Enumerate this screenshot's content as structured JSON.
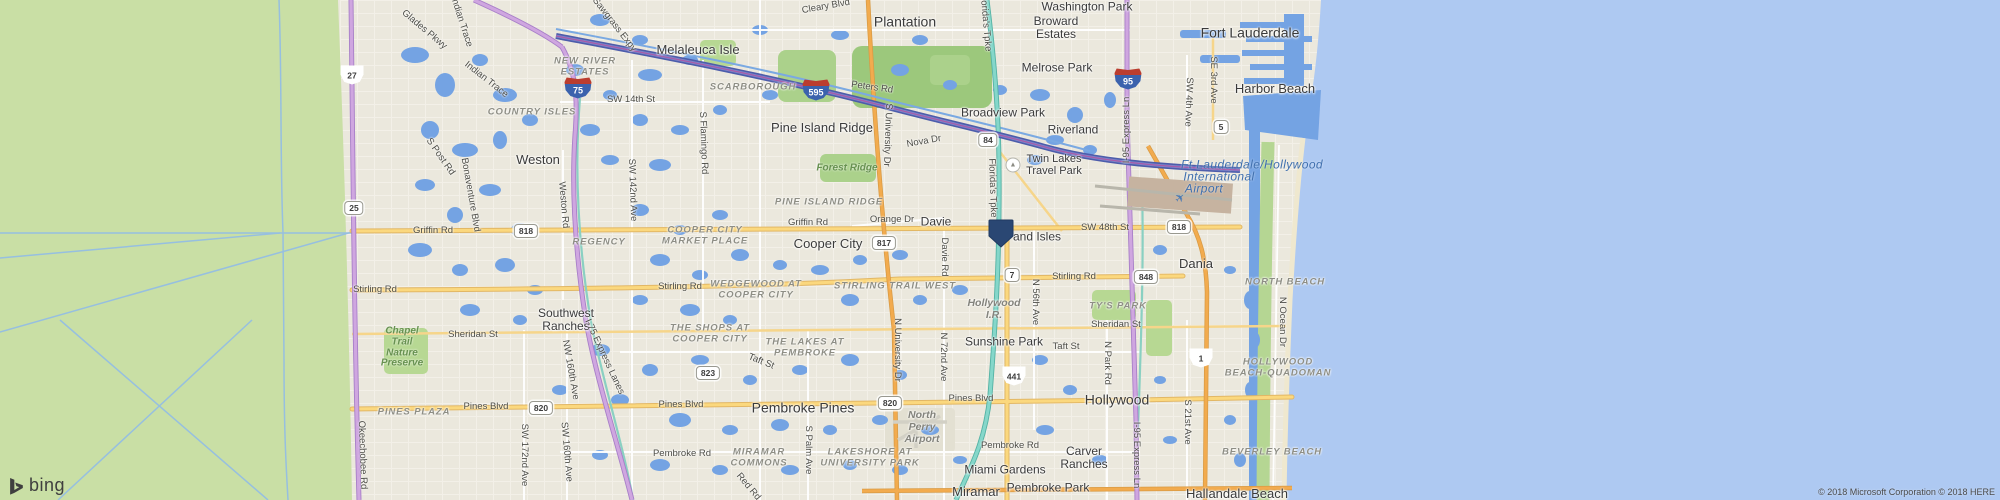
{
  "map": {
    "logo_text": "bing",
    "copyright": "© 2018 Microsoft Corporation © 2018 HERE",
    "colors": {
      "ocean": "#aec9f2",
      "land": "#ebe8dd",
      "everglades": "#c9dfa5",
      "inland_water": "#74a3e3",
      "road_yellow": "#fbd87e",
      "road_orange": "#f2ab4e",
      "toll_purple": "#cfa6e0",
      "turnpike_teal": "#85d7ca",
      "i595_blue": "#4d5cab",
      "marker": "#2a4773",
      "interstate_shield_blue": "#3b62ad",
      "interstate_shield_red": "#bb3d2f"
    },
    "marker": {
      "x": 1001,
      "y": 236,
      "color": "#2a4773"
    },
    "labels": {
      "cities": [
        {
          "t": "Plantation",
          "x": 905,
          "y": 22,
          "s": 14
        },
        {
          "t": "Fort Lauderdale",
          "x": 1250,
          "y": 33,
          "s": 14
        },
        {
          "t": "Washington Park",
          "x": 1087,
          "y": 7,
          "s": 12
        },
        {
          "t": "Broward\nEstates",
          "x": 1056,
          "y": 28,
          "s": 12
        },
        {
          "t": "Melaleuca Isle",
          "x": 698,
          "y": 50,
          "s": 13
        },
        {
          "t": "Melrose Park",
          "x": 1057,
          "y": 68,
          "s": 12
        },
        {
          "t": "Harbor Beach",
          "x": 1275,
          "y": 89,
          "s": 13
        },
        {
          "t": "Pine Island Ridge",
          "x": 822,
          "y": 128,
          "s": 13
        },
        {
          "t": "Broadview Park",
          "x": 1003,
          "y": 113,
          "s": 12
        },
        {
          "t": "Riverland",
          "x": 1073,
          "y": 130,
          "s": 12
        },
        {
          "t": "Weston",
          "x": 538,
          "y": 160,
          "s": 13
        },
        {
          "t": "Davie",
          "x": 936,
          "y": 222,
          "s": 12
        },
        {
          "t": "Cooper City",
          "x": 828,
          "y": 244,
          "s": 13
        },
        {
          "t": "Dania",
          "x": 1196,
          "y": 264,
          "s": 13
        },
        {
          "t": "Southwest\nRanches",
          "x": 566,
          "y": 320,
          "s": 12
        },
        {
          "t": "Sunshine Park",
          "x": 1004,
          "y": 342,
          "s": 12
        },
        {
          "t": "Pembroke Pines",
          "x": 803,
          "y": 408,
          "s": 14
        },
        {
          "t": "Hollywood",
          "x": 1117,
          "y": 400,
          "s": 14
        },
        {
          "t": "Carver\nRanches",
          "x": 1084,
          "y": 458,
          "s": 12
        },
        {
          "t": "Miami Gardens",
          "x": 1005,
          "y": 470,
          "s": 12
        },
        {
          "t": "Miramar",
          "x": 976,
          "y": 492,
          "s": 13
        },
        {
          "t": "Pembroke Park",
          "x": 1048,
          "y": 488,
          "s": 12
        },
        {
          "t": "Hallandale Beach",
          "x": 1237,
          "y": 494,
          "s": 13
        },
        {
          "t": "and Isles",
          "x": 1037,
          "y": 237,
          "s": 12
        },
        {
          "t": "Twin Lakes\nTravel Park",
          "x": 1054,
          "y": 166,
          "s": 11
        }
      ],
      "neighborhoods": [
        {
          "t": "NEW RIVER\nESTATES",
          "x": 585,
          "y": 67
        },
        {
          "t": "COUNTRY ISLES",
          "x": 532,
          "y": 112
        },
        {
          "t": "SCARBOROUGH",
          "x": 753,
          "y": 87
        },
        {
          "t": "REGENCY",
          "x": 599,
          "y": 242
        },
        {
          "t": "COOPER CITY\nMARKET PLACE",
          "x": 705,
          "y": 236
        },
        {
          "t": "PINE ISLAND RIDGE",
          "x": 829,
          "y": 202
        },
        {
          "t": "WEDGEWOOD AT\nCOOPER CITY",
          "x": 756,
          "y": 290
        },
        {
          "t": "STIRLING TRAIL WEST",
          "x": 895,
          "y": 286
        },
        {
          "t": "THE SHOPS AT\nCOOPER CITY",
          "x": 710,
          "y": 334
        },
        {
          "t": "THE LAKES AT\nPEMBROKE",
          "x": 805,
          "y": 348
        },
        {
          "t": "PINES PLAZA",
          "x": 414,
          "y": 412
        },
        {
          "t": "MIRAMAR\nCOMMONS",
          "x": 759,
          "y": 458
        },
        {
          "t": "LAKESHORE AT\nUNIVERSITY PARK",
          "x": 870,
          "y": 458
        },
        {
          "t": "TY'S PARK",
          "x": 1118,
          "y": 306
        },
        {
          "t": "NORTH BEACH",
          "x": 1285,
          "y": 282
        },
        {
          "t": "HOLLYWOOD\nBEACH-QUADOMAN",
          "x": 1278,
          "y": 368
        },
        {
          "t": "BEVERLEY BEACH",
          "x": 1272,
          "y": 452
        }
      ],
      "nature_green": [
        {
          "t": "Forest Ridge",
          "x": 847,
          "y": 169
        },
        {
          "t": "Chapel\nTrail\nNature\nPreserve",
          "x": 402,
          "y": 348
        }
      ],
      "nature_gray": [
        {
          "t": "Hollywood\nI.R.",
          "x": 994,
          "y": 309
        },
        {
          "t": "North\nPerry\nAirport",
          "x": 922,
          "y": 427
        }
      ],
      "water": [
        {
          "t": "Ft Lauderdale/Hollywood",
          "x": 1252,
          "y": 165
        },
        {
          "t": "International",
          "x": 1219,
          "y": 177
        },
        {
          "t": "Airport",
          "x": 1204,
          "y": 189
        }
      ],
      "roads": [
        {
          "t": "Griffin Rd",
          "x": 433,
          "y": 231,
          "r": 0
        },
        {
          "t": "Griffin Rd",
          "x": 808,
          "y": 223,
          "r": 0
        },
        {
          "t": "Orange Dr",
          "x": 892,
          "y": 220,
          "r": 0
        },
        {
          "t": "Stirling Rd",
          "x": 375,
          "y": 290,
          "r": 0
        },
        {
          "t": "Stirling Rd",
          "x": 680,
          "y": 287,
          "r": 0
        },
        {
          "t": "Stirling Rd",
          "x": 1074,
          "y": 277,
          "r": 0
        },
        {
          "t": "Sheridan St",
          "x": 473,
          "y": 335,
          "r": 0
        },
        {
          "t": "Sheridan St",
          "x": 1116,
          "y": 325,
          "r": 0
        },
        {
          "t": "Pines Blvd",
          "x": 486,
          "y": 407,
          "r": 0
        },
        {
          "t": "Pines Blvd",
          "x": 681,
          "y": 405,
          "r": 0
        },
        {
          "t": "Pines Blvd",
          "x": 971,
          "y": 399,
          "r": 0
        },
        {
          "t": "Pembroke Rd",
          "x": 682,
          "y": 454,
          "r": 0
        },
        {
          "t": "Pembroke Rd",
          "x": 1010,
          "y": 446,
          "r": 0
        },
        {
          "t": "Taft St",
          "x": 761,
          "y": 362,
          "r": 22
        },
        {
          "t": "Taft St",
          "x": 1066,
          "y": 347,
          "r": 0
        },
        {
          "t": "SW 14th St",
          "x": 631,
          "y": 100,
          "r": 0
        },
        {
          "t": "SW 48th St",
          "x": 1105,
          "y": 228,
          "r": 0
        },
        {
          "t": "Peters Rd",
          "x": 872,
          "y": 88,
          "r": 8
        },
        {
          "t": "Cleary Blvd",
          "x": 826,
          "y": 7,
          "r": -10
        },
        {
          "t": "Nova Dr",
          "x": 924,
          "y": 142,
          "r": -10
        },
        {
          "t": "Sawgrass Expy",
          "x": 614,
          "y": 25,
          "r": 52
        },
        {
          "t": "Glades Pkwy",
          "x": 424,
          "y": 30,
          "r": 40
        },
        {
          "t": "Indian Trace",
          "x": 461,
          "y": 22,
          "r": 72
        },
        {
          "t": "Indian Trace",
          "x": 486,
          "y": 80,
          "r": 38
        },
        {
          "t": "S Post Rd",
          "x": 440,
          "y": 157,
          "r": 55
        },
        {
          "t": "Bonaventure Blvd",
          "x": 470,
          "y": 195,
          "r": 80
        },
        {
          "t": "Weston Rd",
          "x": 563,
          "y": 205,
          "r": 85
        },
        {
          "t": "SW 142nd Ave",
          "x": 632,
          "y": 190,
          "r": 88
        },
        {
          "t": "S Flamingo Rd",
          "x": 703,
          "y": 143,
          "r": 88
        },
        {
          "t": "S University Dr",
          "x": 887,
          "y": 135,
          "r": 92
        },
        {
          "t": "N University Dr",
          "x": 897,
          "y": 350,
          "r": 90
        },
        {
          "t": "Davie Rd",
          "x": 944,
          "y": 257,
          "r": 90
        },
        {
          "t": "N 72nd Ave",
          "x": 943,
          "y": 357,
          "r": 90
        },
        {
          "t": "NW 160th Ave",
          "x": 570,
          "y": 370,
          "r": 80
        },
        {
          "t": "SW 160th Ave",
          "x": 566,
          "y": 452,
          "r": 85
        },
        {
          "t": "SW 172nd Ave",
          "x": 524,
          "y": 455,
          "r": 90
        },
        {
          "t": "N 56th Ave",
          "x": 1035,
          "y": 302,
          "r": 90
        },
        {
          "t": "S Palm Ave",
          "x": 808,
          "y": 450,
          "r": 90
        },
        {
          "t": "N Park Rd",
          "x": 1107,
          "y": 363,
          "r": 90
        },
        {
          "t": "S 21st Ave",
          "x": 1187,
          "y": 422,
          "r": 90
        },
        {
          "t": "SW 4th Ave",
          "x": 1188,
          "y": 102,
          "r": 92
        },
        {
          "t": "SE 3rd Ave",
          "x": 1213,
          "y": 80,
          "r": 90
        },
        {
          "t": "N Ocean Dr",
          "x": 1282,
          "y": 322,
          "r": 90
        },
        {
          "t": "Red Rd",
          "x": 748,
          "y": 487,
          "r": 50
        },
        {
          "t": "Okeechobee Rd",
          "x": 362,
          "y": 455,
          "r": 88
        },
        {
          "t": "I-75 Express Lanes",
          "x": 604,
          "y": 357,
          "r": 65
        },
        {
          "t": "I-95 Express Ln",
          "x": 1127,
          "y": 130,
          "r": -90
        },
        {
          "t": "I-95 Express Ln",
          "x": 1136,
          "y": 455,
          "r": 90
        },
        {
          "t": "Florida's Tpke",
          "x": 985,
          "y": 22,
          "r": 85
        },
        {
          "t": "Florida's Tpke",
          "x": 992,
          "y": 188,
          "r": 88
        }
      ]
    },
    "shields": [
      {
        "n": "27",
        "x": 352,
        "y": 75,
        "k": "us"
      },
      {
        "n": "25",
        "x": 354,
        "y": 208,
        "k": "st"
      },
      {
        "n": "75",
        "x": 578,
        "y": 88,
        "k": "i"
      },
      {
        "n": "595",
        "x": 816,
        "y": 90,
        "k": "i"
      },
      {
        "n": "95",
        "x": 1128,
        "y": 79,
        "k": "i"
      },
      {
        "n": "84",
        "x": 988,
        "y": 140,
        "k": "st"
      },
      {
        "n": "817",
        "x": 884,
        "y": 243,
        "k": "st"
      },
      {
        "n": "818",
        "x": 526,
        "y": 231,
        "k": "st"
      },
      {
        "n": "818",
        "x": 1179,
        "y": 227,
        "k": "st"
      },
      {
        "n": "848",
        "x": 1146,
        "y": 277,
        "k": "st"
      },
      {
        "n": "823",
        "x": 708,
        "y": 373,
        "k": "st"
      },
      {
        "n": "820",
        "x": 541,
        "y": 408,
        "k": "st"
      },
      {
        "n": "820",
        "x": 890,
        "y": 403,
        "k": "st"
      },
      {
        "n": "7",
        "x": 1012,
        "y": 275,
        "k": "st"
      },
      {
        "n": "5",
        "x": 1221,
        "y": 127,
        "k": "st"
      },
      {
        "n": "441",
        "x": 1014,
        "y": 376,
        "k": "us"
      },
      {
        "n": "1",
        "x": 1201,
        "y": 358,
        "k": "us"
      }
    ],
    "icons": [
      {
        "g": "✈",
        "x": 1180,
        "y": 198,
        "c": "#4a7ab5",
        "s": 12,
        "r": -40,
        "name": "airplane-icon",
        "circle": false
      },
      {
        "g": "▲",
        "x": 1013,
        "y": 165,
        "c": "#8b8b83",
        "s": 7,
        "r": 0,
        "name": "campground-icon",
        "circle": true
      }
    ]
  }
}
